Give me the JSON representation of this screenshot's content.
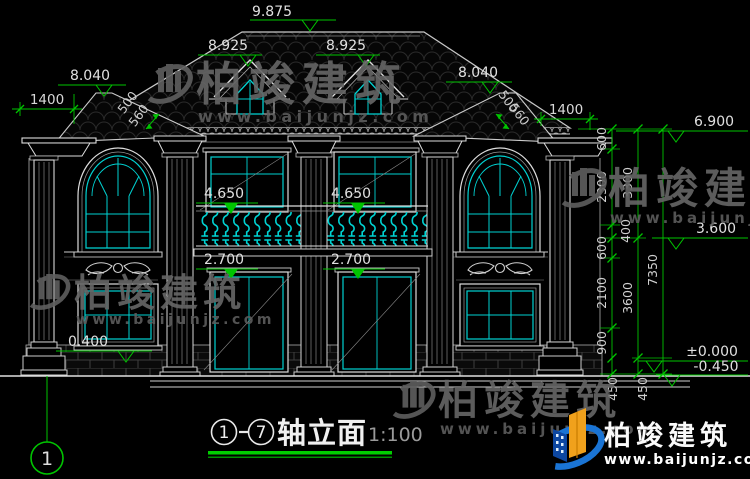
{
  "drawing": {
    "title": {
      "axis_start": "1",
      "axis_end": "7",
      "name": "轴立面",
      "scale": "1:100"
    },
    "axis_bubble": "1",
    "markers": {
      "ridge": "9.875",
      "dormer_left": "8.925",
      "dormer_right": "8.925",
      "wing_left": "8.040",
      "wing_right": "8.040",
      "eave_right": "6.900",
      "mid_right": "3.600",
      "zero": "±0.000",
      "minus": "-0.450",
      "balcony_left": "4.650",
      "balcony_right": "4.650",
      "floor_left": "2.700",
      "floor_right": "2.700",
      "sill_left": "0.400"
    },
    "dims": {
      "overhang_left": "1400",
      "overhang_right": "1400",
      "slope": [
        "500",
        "560"
      ],
      "chain_inner": [
        "600",
        "2300",
        "400",
        "600",
        "2100",
        "900",
        "450"
      ],
      "chain_mid": [
        "3300",
        "3600",
        "450"
      ],
      "chain_outer": [
        "7350"
      ]
    }
  },
  "watermark": {
    "cn": "柏竣建筑",
    "url": "www.baijunjz.com"
  },
  "brand": {
    "cn": "柏竣建筑",
    "url": "www.baijunjz.com"
  },
  "colors": {
    "line": "#d6d6d6",
    "dim": "#00c400",
    "glass": "#00d2d2",
    "underline": "#00cf00"
  }
}
